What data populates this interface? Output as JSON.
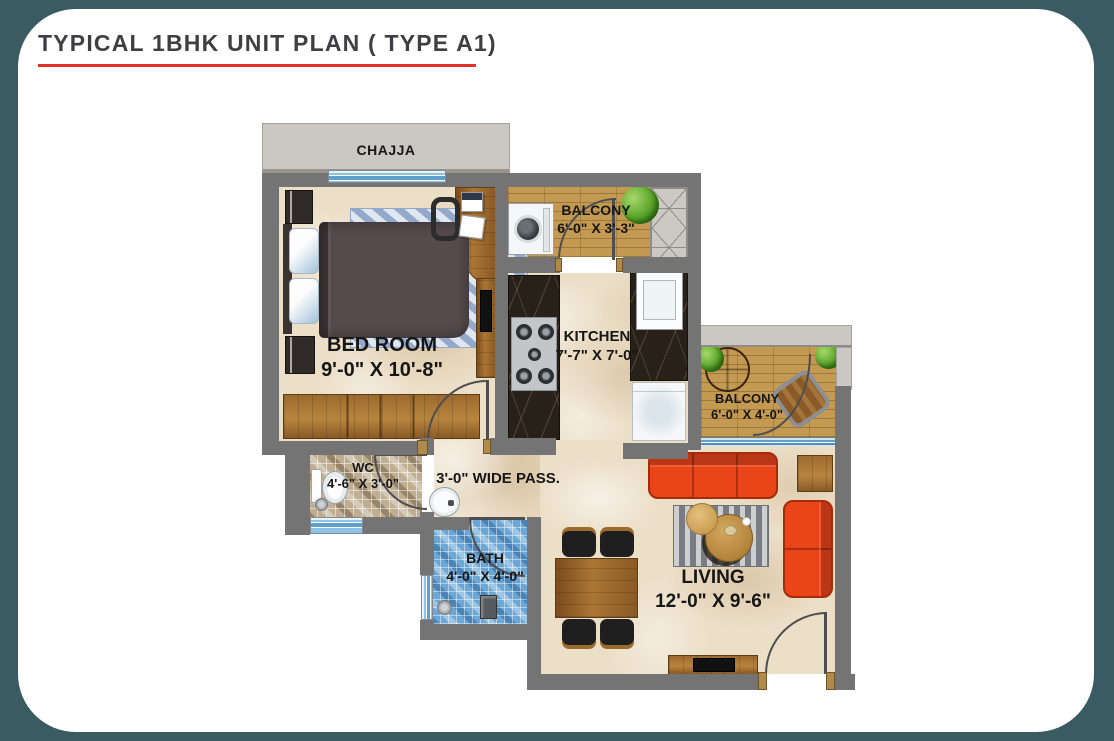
{
  "title": "TYPICAL 1BHK UNIT PLAN ( TYPE A1)",
  "plan": {
    "chajja_label": "CHAJJA",
    "rooms": {
      "balcony_top": {
        "name": "BALCONY",
        "dims": "6'-0\" X 3'-3\""
      },
      "bedroom": {
        "name": "BED ROOM",
        "dims": "9'-0\" X 10'-8\""
      },
      "kitchen": {
        "name": "KITCHEN",
        "dims": "7'-7\" X 7'-0\""
      },
      "balcony_right": {
        "name": "BALCONY",
        "dims": "6'-0\" X 4'-0\""
      },
      "wc": {
        "name": "WC",
        "dims": "4'-6\" X 3'-0\""
      },
      "passage": {
        "name": "3'-0\" WIDE PASS.",
        "dims": ""
      },
      "bath": {
        "name": "BATH",
        "dims": "4'-0\" X 4'-0\""
      },
      "living": {
        "name": "LIVING",
        "dims": "12'-0\" X 9'-6\""
      }
    },
    "furniture": [
      "bed",
      "wardrobe",
      "study-desk",
      "desk-chair",
      "washing-machine",
      "gas-stove",
      "kitchen-sink",
      "refrigerator",
      "duct-shaft",
      "sofa-3-seat",
      "sofa-2-seat",
      "coffee-tables",
      "dining-table",
      "dining-chairs",
      "tv-unit",
      "side-table",
      "toilet",
      "wash-basin",
      "shower",
      "floor-drain",
      "balcony-table",
      "balcony-chair",
      "plants",
      "door-swings",
      "windows"
    ]
  },
  "colors": {
    "frame_teal": "#3a5b61",
    "accent_red": "#e23128",
    "wall_gray": "#747474",
    "chajja_gray": "#cbc7c2",
    "floor_beige": "#ecdfc8",
    "deck_wood": "#c49a52",
    "sofa_orange": "#e8431d",
    "bath_tile_blue": "#6aa7d6",
    "wc_tile_tan": "#bfae92",
    "counter_marble": "#27211a",
    "label_black": "#161616"
  }
}
